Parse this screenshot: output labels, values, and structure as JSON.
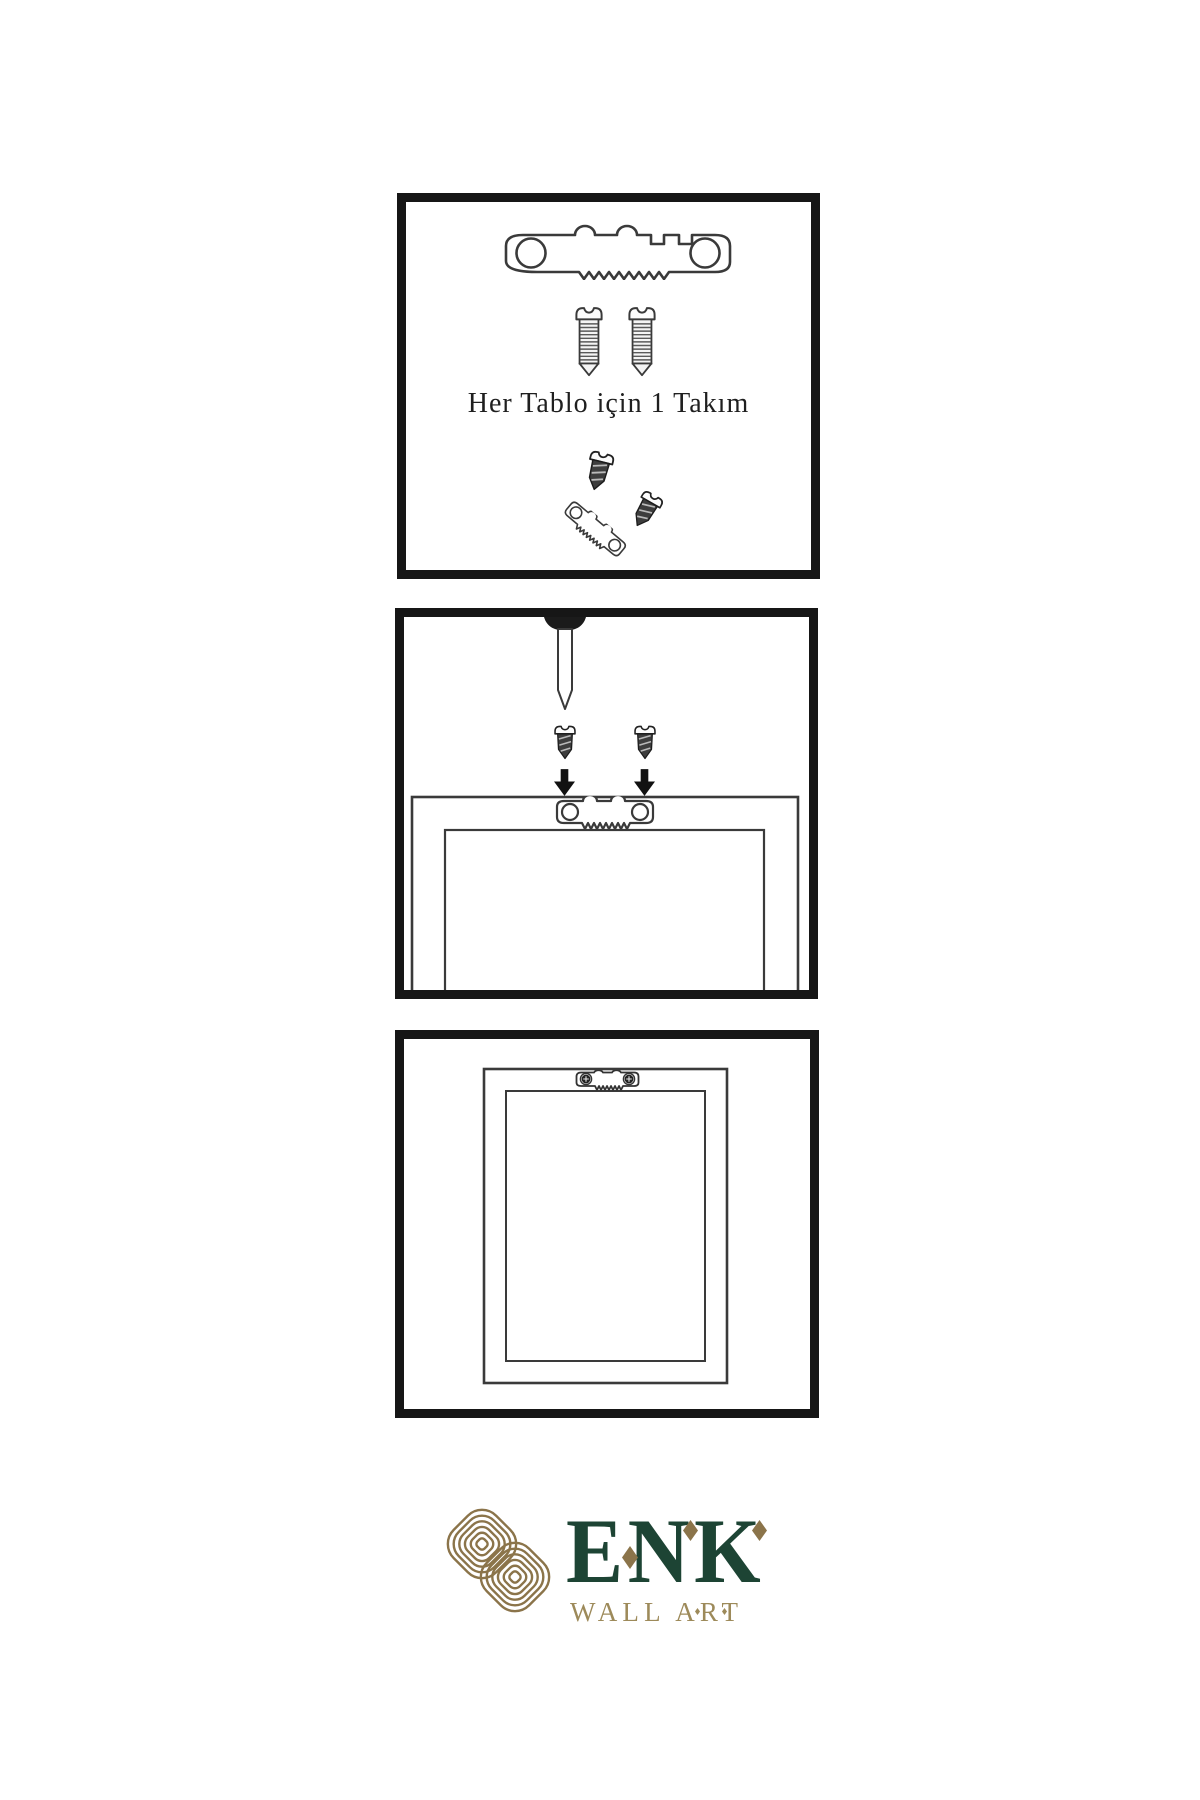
{
  "colors": {
    "background": "#ffffff",
    "panel_border": "#161616",
    "line_art": "#3a3a3a",
    "logo_green": "#1d4434",
    "logo_gold": "#8b744a",
    "logo_gold_light": "#9d8a5a"
  },
  "panel1": {
    "caption": "Her Tablo için 1 Takım",
    "icons": [
      "sawtooth-hanger-icon",
      "screw-icon",
      "screw-icon",
      "hanger-assembly-icon"
    ]
  },
  "panel2": {
    "icons": [
      "wall-nail-icon",
      "screw-icon",
      "screw-icon",
      "down-arrow-icon",
      "down-arrow-icon",
      "frame-back-with-hanger-icon"
    ]
  },
  "panel3": {
    "icons": [
      "hung-frame-with-hanger-icon"
    ]
  },
  "logo": {
    "brand": "ENK",
    "subtitle": "WALL ART"
  }
}
